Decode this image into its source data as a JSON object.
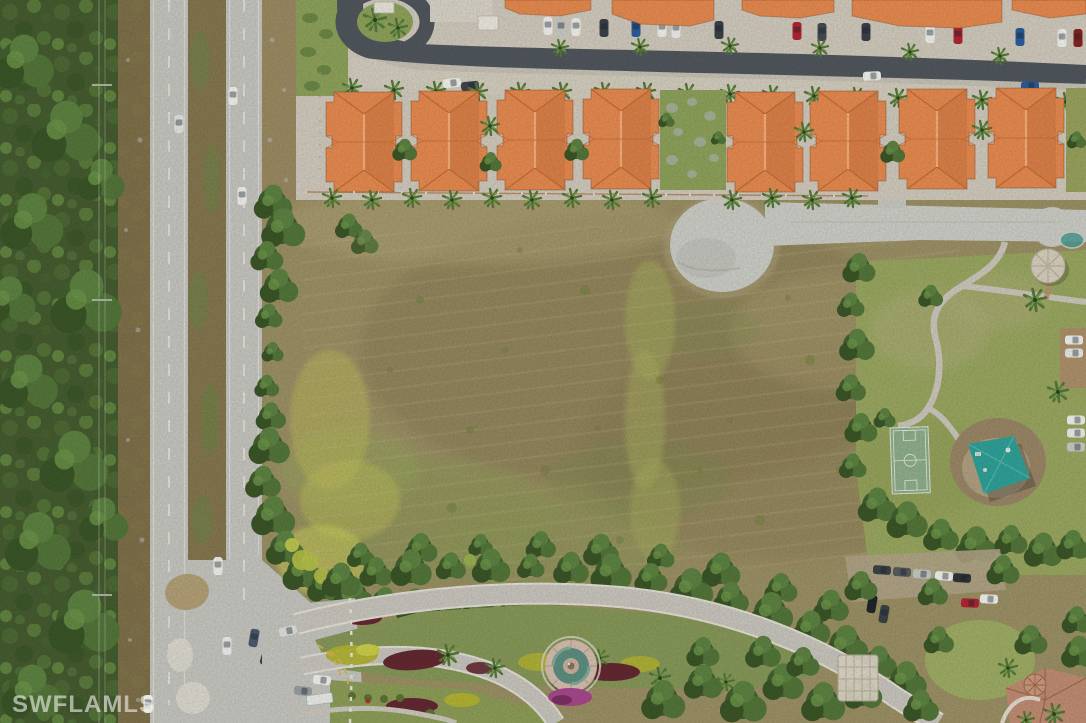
{
  "meta": {
    "type": "aerial-photograph",
    "description": "Aerial drone photo of a vacant land parcel bordered by a divided highway and forest preserve on the west, a row of orange tile-roofed condominium buildings on the north, a community park with basketball court, shaded playground and gazebo on the east, and a landscaped entrance boulevard with a fountain median on the south."
  },
  "watermark": {
    "text": "SWFLAMLS",
    "color": "#f3f2ee"
  },
  "colors": {
    "field": "#9c9166",
    "field_brown": "#8a7c55",
    "field_tan": "#b3a678",
    "field_green": "#8c9a57",
    "field_yellow": "#c2c15c",
    "forest": "#465c30",
    "dirt_strip": "#8a744f",
    "highway": "#c7c7c3",
    "median_scrub": "#85774f",
    "asphalt": "#50575d",
    "parking_pale": "#d2ccc0",
    "roof_orange": "#e88b51",
    "pad_concrete": "#cdcfc9",
    "lawn": "#9aa861",
    "court": "#8fb08c",
    "canopy": "#2fa29a",
    "mulch_red": "#642832",
    "bush_yellow": "#b3b433",
    "flower_magenta": "#a8488f",
    "road_light": "#c9c7c0",
    "path": "#cdc9c0",
    "fountain_ring": "#d8c0b2",
    "fountain_basin": "#5d8f82",
    "gazebo_roof": "#d8d1c2",
    "clubhouse_roof": "#c28d74",
    "car_white": "#f2f3f1",
    "car_red": "#b22531",
    "car_blue": "#2b5d9e",
    "car_dark": "#3a4148"
  },
  "scene": {
    "regions": [
      {
        "name": "forest-preserve",
        "label": "Wooded preserve with power line corridor"
      },
      {
        "name": "divided-highway",
        "label": "Four-lane divided highway with scrub median"
      },
      {
        "name": "vacant-parcel",
        "label": "Cleared vacant lot with mowing rows and weed patches"
      },
      {
        "name": "abandoned-pad",
        "label": "Old concrete teardrop pad and access road"
      },
      {
        "name": "condo-row",
        "label": "Eight orange tile-roof condo buildings with parking and palms",
        "building_count": 8
      },
      {
        "name": "community-park",
        "label": "Park lawn, basketball court, shade-sail playground, gazebo"
      },
      {
        "name": "entrance-boulevard",
        "label": "Curved divided entrance drive with fountain median and flower beds"
      },
      {
        "name": "clubhouse-corner",
        "label": "Tile-roof clubhouse structure at bottom right"
      }
    ]
  }
}
